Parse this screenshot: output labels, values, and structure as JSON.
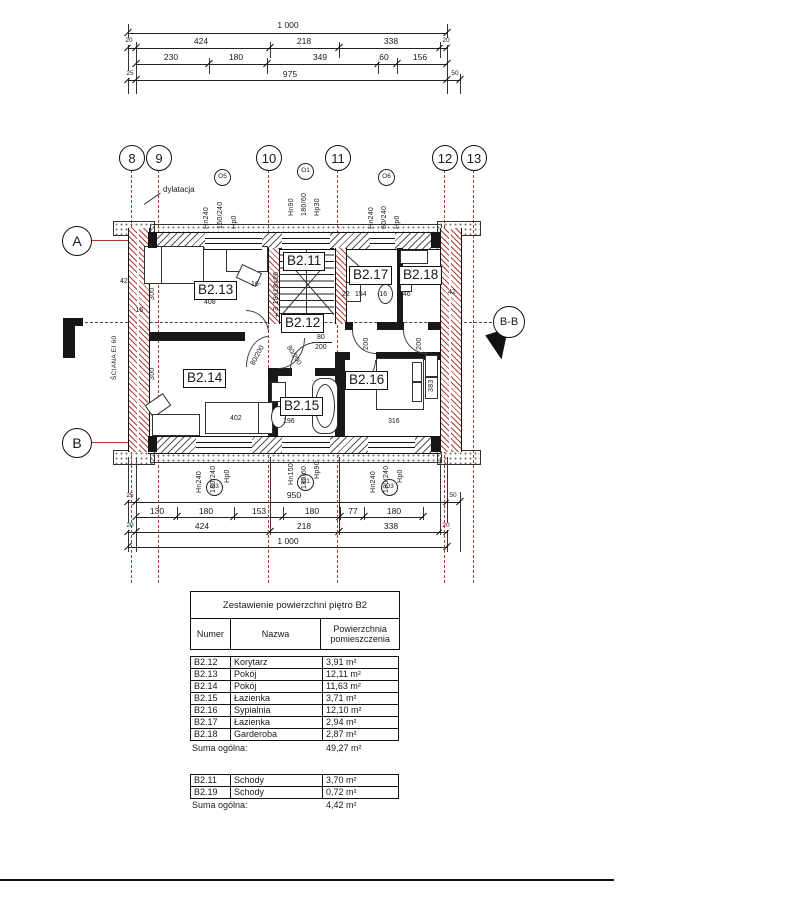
{
  "top_dims": {
    "total": "1 000",
    "row2": [
      "20",
      "424",
      "218",
      "338",
      "20"
    ],
    "row3": [
      "230",
      "180",
      "349",
      "60",
      "156"
    ],
    "row4": [
      "25",
      "975",
      "50"
    ]
  },
  "grid_bubbles": [
    "8",
    "9",
    "10",
    "11",
    "12",
    "13"
  ],
  "axes": {
    "a": "A",
    "b": "B",
    "section": "B-B"
  },
  "notes": {
    "dylatacja": "dylatacja",
    "sciana": "ŚCIANA EI 60",
    "stairs": "±3 18x18x26"
  },
  "windows_top": [
    {
      "code": "O5",
      "hn": "Hn240",
      "size": "160/240",
      "hp": "Hp0"
    },
    {
      "code": "O1",
      "hn": "Hn90",
      "size": "180/60",
      "hp": "Hp30"
    },
    {
      "code": "O6",
      "hn": "Hn240",
      "size": "60/240",
      "hp": "Hp0"
    }
  ],
  "windows_bottom": [
    {
      "code": "O3",
      "hn": "Hn240",
      "size": "180/240",
      "hp": "Hp0"
    },
    {
      "code": "O1",
      "hn": "Hn150",
      "size": "180/60",
      "hp": "Hp90"
    },
    {
      "code": "O3",
      "hn": "Hn240",
      "size": "180/240",
      "hp": "Hp0"
    }
  ],
  "rooms": [
    "B2.11",
    "B2.12",
    "B2.13",
    "B2.14",
    "B2.15",
    "B2.16",
    "B2.17",
    "B2.18"
  ],
  "plan_dims": {
    "d300": "300",
    "d42": "42",
    "d408": "408",
    "d16": "16-",
    "dm16": "-16",
    "d22": "22",
    "d154": "154",
    "d146": "146",
    "d80200": "80/200",
    "d80": "80",
    "d200": "200",
    "d402": "402",
    "d196": "196",
    "d316": "316",
    "d383": "383"
  },
  "bottom_dims": {
    "row1": [
      "25",
      "950",
      "50"
    ],
    "row2": [
      "130",
      "180",
      "153",
      "180",
      "77",
      "180"
    ],
    "row3": [
      "20",
      "424",
      "218",
      "338",
      "20"
    ],
    "total": "1 000"
  },
  "area_table": {
    "title": "Zestawienie powierzchni piętro B2",
    "headers": [
      "Numer",
      "Nazwa",
      "Powierzchnia pomieszczenia"
    ],
    "rows": [
      [
        "B2.12",
        "Korytarz",
        "3,91 m²"
      ],
      [
        "B2.13",
        "Pokój",
        "12,11 m²"
      ],
      [
        "B2.14",
        "Pokój",
        "11,63 m²"
      ],
      [
        "B2.15",
        "Łazienka",
        "3,71 m²"
      ],
      [
        "B2.16",
        "Sypialnia",
        "12,10 m²"
      ],
      [
        "B2.17",
        "Łazienka",
        "2,94 m²"
      ],
      [
        "B2.18",
        "Garderoba",
        "2,87 m²"
      ]
    ],
    "sum_label": "Suma ogólna:",
    "sum_value": "49,27 m²"
  },
  "stairs_table": {
    "rows": [
      [
        "B2.11",
        "Schody",
        "3,70 m²"
      ],
      [
        "B2.19",
        "Schody",
        "0,72 m²"
      ]
    ],
    "sum_label": "Suma ogólna:",
    "sum_value": "4,42 m²"
  }
}
